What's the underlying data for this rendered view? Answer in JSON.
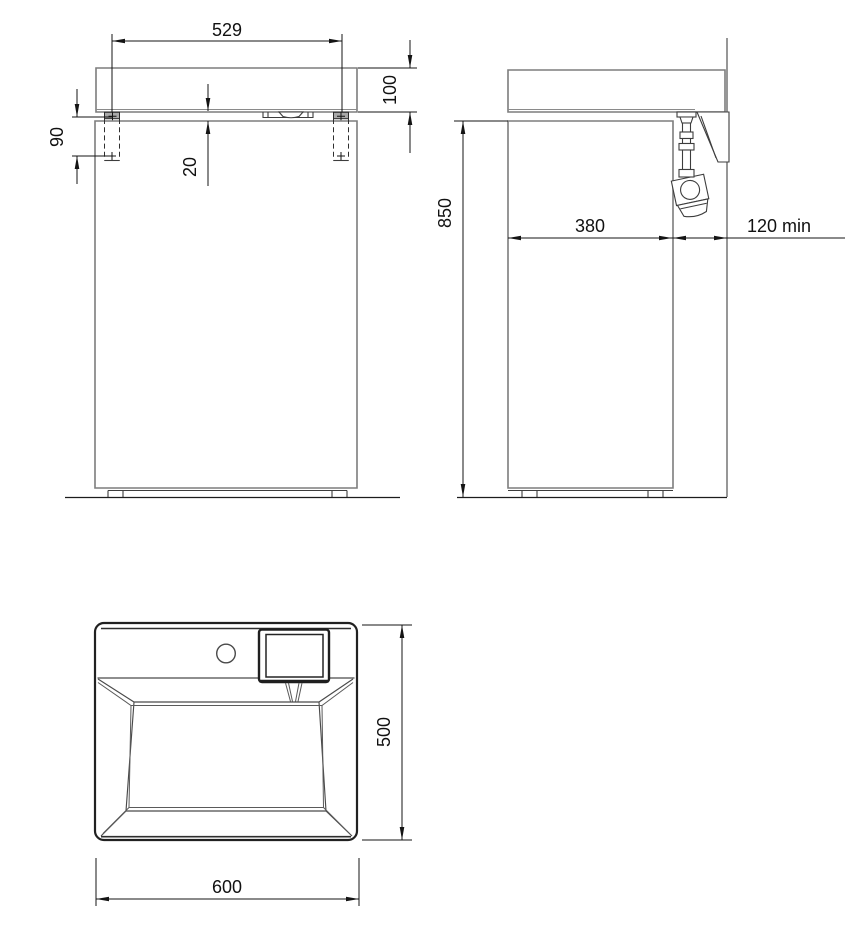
{
  "front_view": {
    "width_between_fixings": "529",
    "basin_height": "100",
    "fixing_height": "90",
    "gap": "20"
  },
  "side_view": {
    "height": "850",
    "cabinet_depth": "380",
    "wall_clearance": "120 min"
  },
  "top_view": {
    "depth": "500",
    "width": "600"
  }
}
